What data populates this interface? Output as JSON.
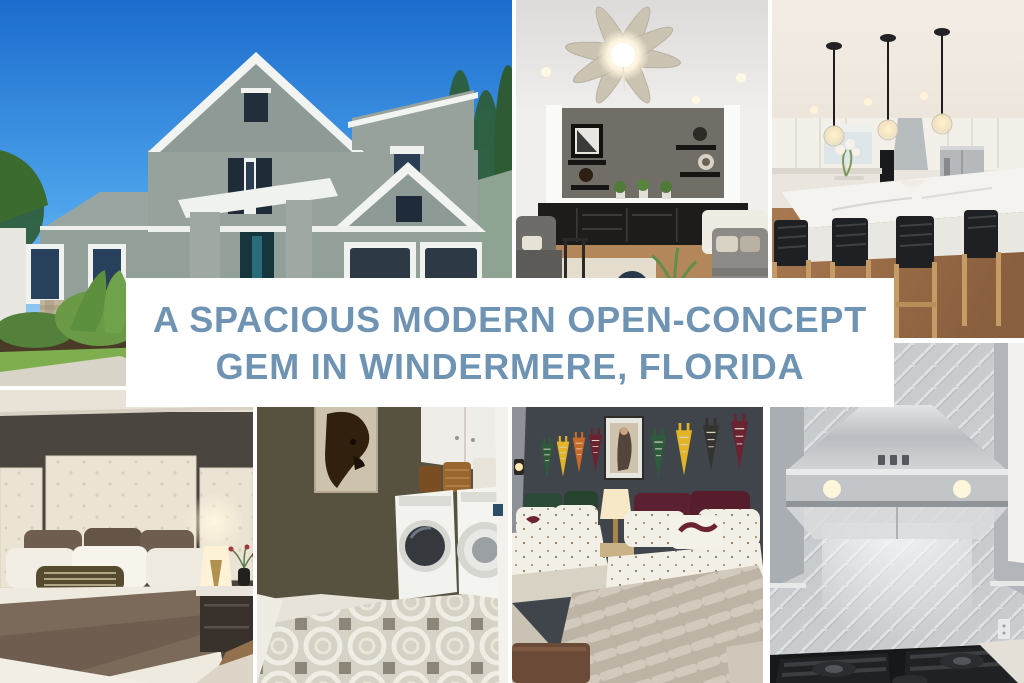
{
  "banner": {
    "line1": "A SPACIOUS MODERN OPEN-CONCEPT",
    "line2": "GEM IN WINDERMERE, FLORIDA",
    "text_color": "#6f93b2",
    "background_color": "#ffffff"
  },
  "collage": {
    "background_color": "#ffffff",
    "photos": [
      {
        "name": "house-exterior-photo"
      },
      {
        "name": "living-room-photo"
      },
      {
        "name": "kitchen-island-photo"
      },
      {
        "name": "primary-bedroom-photo"
      },
      {
        "name": "laundry-room-photo"
      },
      {
        "name": "pennant-bedroom-photo"
      },
      {
        "name": "range-hood-photo"
      }
    ]
  }
}
